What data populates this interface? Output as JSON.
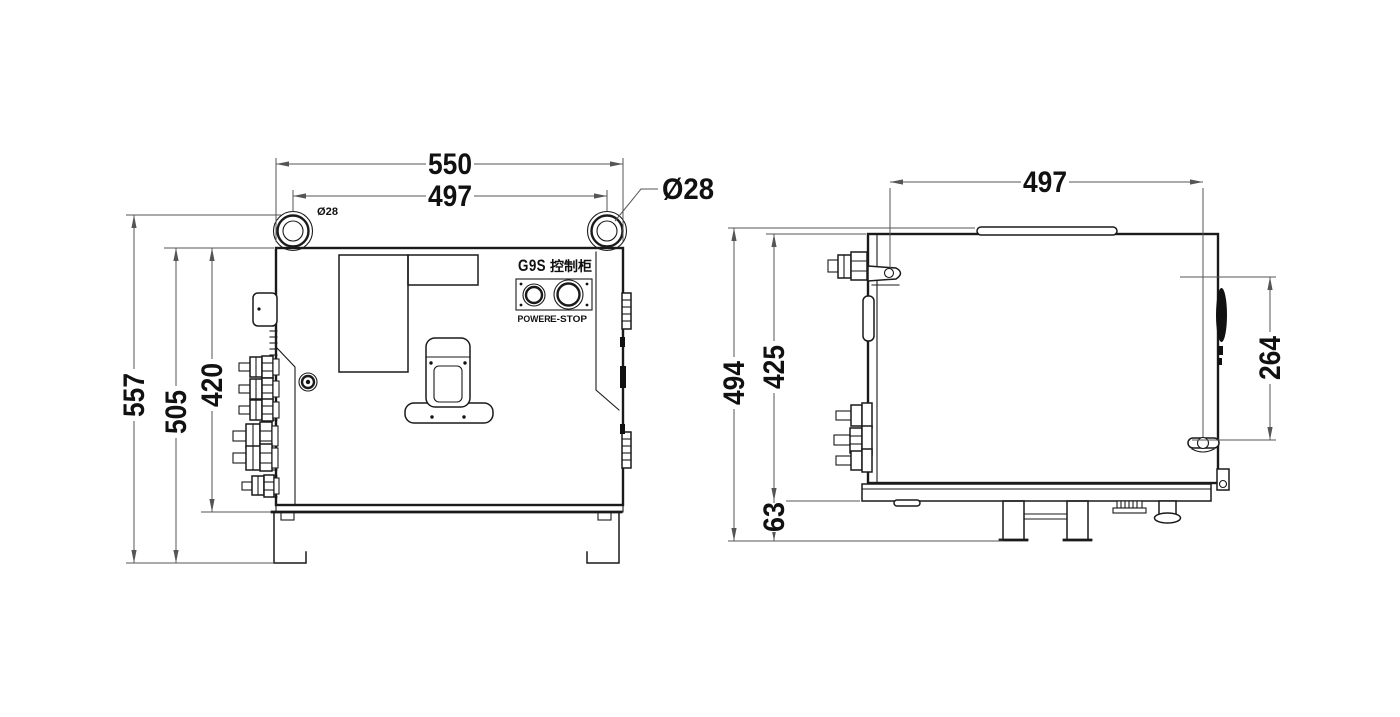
{
  "drawing": {
    "colors": {
      "line": "#1a1a1a",
      "dimension": "#555555",
      "background": "#ffffff"
    }
  },
  "front_view": {
    "panel": {
      "brand": "G9S",
      "brand_suffix": "控制柜",
      "power_label": "POWER",
      "estop_label": "E-STOP"
    },
    "dims": {
      "overall_width": "550",
      "hole_spacing": "497",
      "hole_note": "Ø28",
      "hole_callout": "Ø28",
      "overall_height": "557",
      "body_height": "505",
      "door_height": "420"
    }
  },
  "side_view": {
    "dims": {
      "latch_span": "497",
      "overall_height": "494",
      "body_height": "425",
      "handle_span": "264",
      "foot_height": "63"
    }
  }
}
